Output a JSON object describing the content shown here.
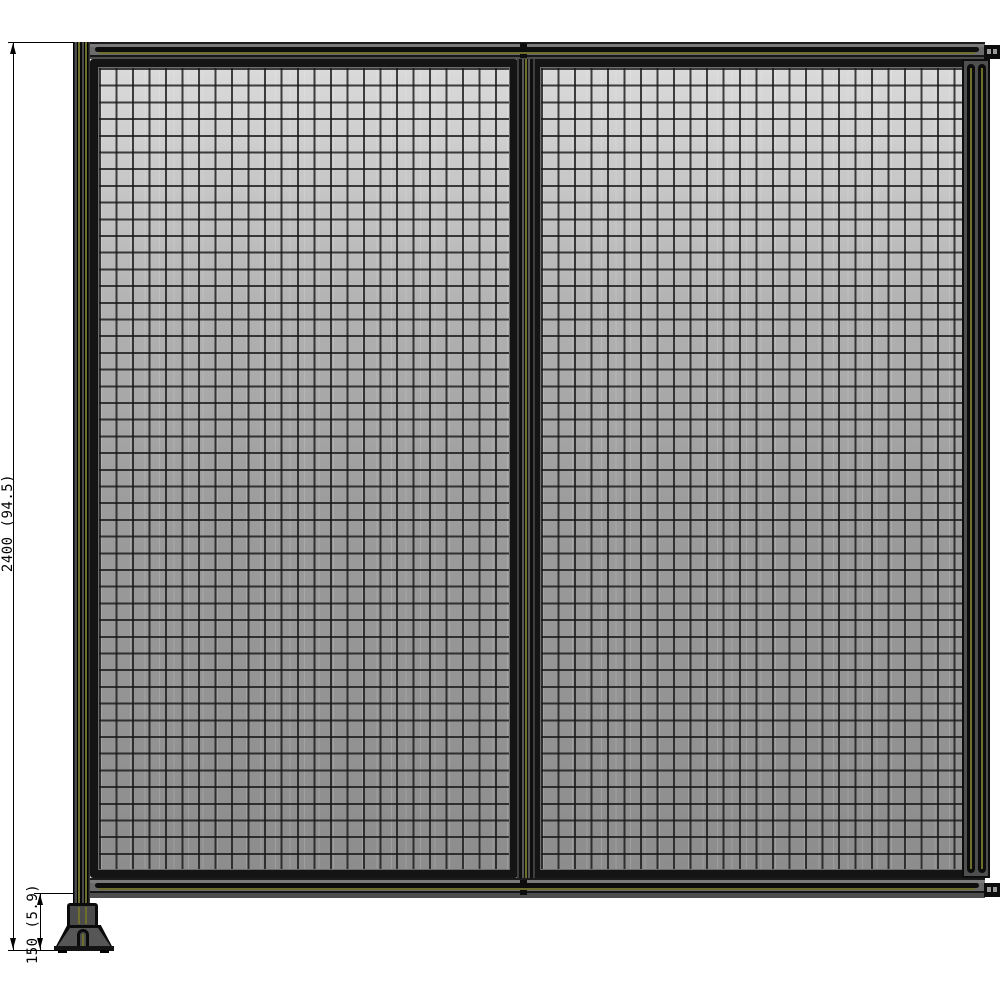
{
  "drawing": {
    "kind": "wire-mesh-partition-front-elevation",
    "dimension_labels": {
      "overall_height": "2400 (94.5)",
      "foot_height": "150 (5.9)"
    },
    "components": [
      "left-upright-post",
      "top-rail",
      "bottom-rail",
      "mesh-panel-left",
      "mesh-panel-right",
      "center-divider-post",
      "right-end-post",
      "connector-bracket-top-right",
      "connector-bracket-bottom-right",
      "leveling-foot"
    ],
    "colors": {
      "background": "#ffffff",
      "annotation": "#000000",
      "frame_dark": "#141414",
      "rail_gray": "#6e6e6e",
      "tslot_accent": "#6f6f2d",
      "mesh_light": "#dadada",
      "mesh_dark": "#8d8d8d",
      "wire": "#2a2a2a"
    }
  }
}
